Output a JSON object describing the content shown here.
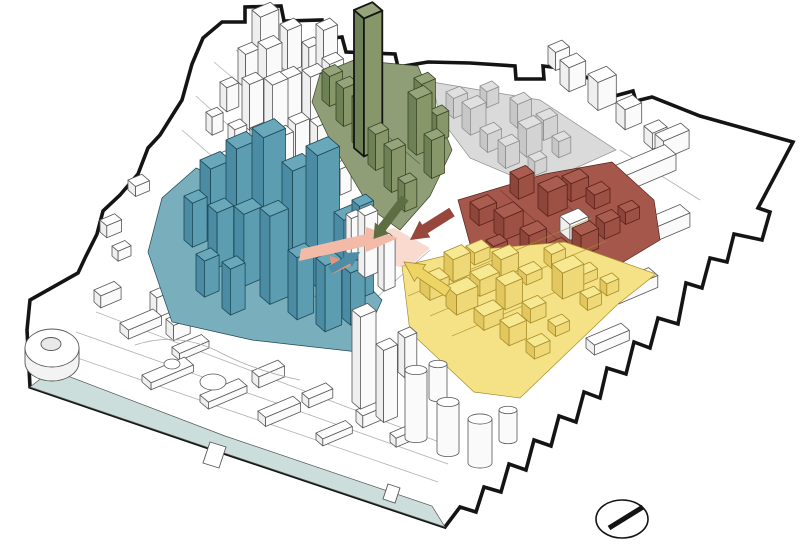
{
  "figure": {
    "kind": "axonometric-urban-massing-diagram",
    "compass_icon": "north-arrow-icon"
  },
  "canvas": {
    "bg": "#ffffff",
    "boundary": "#141414",
    "water": "#cbdedc",
    "street": "#a8a8a8",
    "line": "#565656"
  },
  "palettes": {
    "white": {
      "ground": "#ffffff",
      "top": "#ffffff",
      "side": "#efefef",
      "front": "#fafafa",
      "line": "#565656"
    },
    "blue": {
      "ground": "#79aebd",
      "top": "#69a7ba",
      "side": "#4b8ba3",
      "front": "#5d9db1",
      "line": "#1c4856"
    },
    "green": {
      "ground": "#8f9e76",
      "top": "#95a47b",
      "side": "#6e8156",
      "front": "#879769",
      "line": "#3a4525"
    },
    "greenTower": {
      "ground": "#8f9e76",
      "top": "#95a47b",
      "side": "#6e8156",
      "front": "#879769",
      "line": "#141414"
    },
    "red": {
      "ground": "#a5574c",
      "top": "#a95c50",
      "side": "#8e463b",
      "front": "#9d5044",
      "line": "#5a221b"
    },
    "yellow": {
      "ground": "#f5e286",
      "top": "#f7e892",
      "side": "#e2c75e",
      "front": "#eed877",
      "line": "#a88c2c"
    },
    "gray": {
      "ground": "#dadada",
      "top": "#e0e0e0",
      "side": "#c7c7c7",
      "front": "#d3d3d3",
      "line": "#8f8f8f"
    }
  },
  "arrows": {
    "salmon": "#f3bba7",
    "salmon_deep": "#e8947c",
    "green": "#5d6e43",
    "red": "#97473b",
    "yellow": "#eed465",
    "teal": "#4d8da5"
  },
  "zones": [
    {
      "id": "blue-highrise-district",
      "color": "#69a7ba"
    },
    {
      "id": "green-landmark-district",
      "color": "#95a47b"
    },
    {
      "id": "red-lowrise-district",
      "color": "#a95c50"
    },
    {
      "id": "yellow-lowrise-district",
      "color": "#f7e892"
    },
    {
      "id": "gray-district",
      "color": "#dadada"
    },
    {
      "id": "waterfront",
      "color": "#cbdedc"
    }
  ]
}
